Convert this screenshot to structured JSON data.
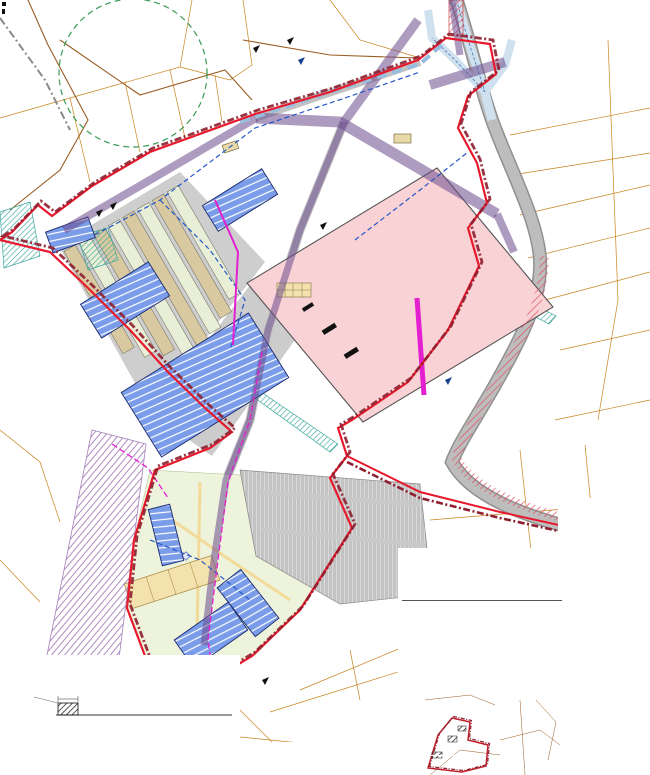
{
  "map": {
    "labels": [
      {
        "text": "Kanala tee 47",
        "sub": "35801:004:0760",
        "x": 534,
        "y": 6,
        "size": 3.2
      },
      {
        "text": "Kanala tee 41",
        "sub": "35801:004:0764",
        "x": 508,
        "y": 22,
        "size": 4.4
      },
      {
        "text": "Kanala tee 45",
        "sub": "35801:004:0771",
        "x": 497,
        "y": 57,
        "size": 3.4
      },
      {
        "text": "Kanala tee 44",
        "sub": "35801:004:0770",
        "x": 500,
        "y": 71,
        "size": 4.0
      },
      {
        "text": "Kanala tee 42",
        "sub": "35801:004:0490",
        "x": 508,
        "y": 110,
        "size": 4.2
      },
      {
        "text": "Kanala tee 42a",
        "sub": "35801:004:0480",
        "x": 505,
        "y": 134,
        "size": 3.4
      },
      {
        "text": "Kanala tee 40",
        "sub": "35801:004:0810",
        "x": 517,
        "y": 152,
        "size": 4.0
      },
      {
        "text": "Kanala tee 38",
        "sub": "35801:004:1580",
        "x": 519,
        "y": 183,
        "size": 4.0
      },
      {
        "text": "Kanala tee 36",
        "sub": "35801:004:0050",
        "x": 528,
        "y": 212,
        "size": 4.0
      },
      {
        "text": "Kanala tee 34",
        "sub": "35801:004:0040",
        "x": 560,
        "y": 252,
        "size": 4.0
      },
      {
        "text": "Kanala tee 31",
        "sub": "35801:004:1360",
        "x": 590,
        "y": 280,
        "size": 4.0
      },
      {
        "text": "Kanala tee 26",
        "sub": "35801:004:0021",
        "x": 583,
        "y": 396,
        "size": 3.8
      },
      {
        "text": "Kanala tee 24",
        "sub": "35801:004:0020",
        "x": 538,
        "y": 428,
        "size": 3.6
      },
      {
        "text": "Kanala põik 7",
        "sub": "35801:004:0100",
        "x": 546,
        "y": 464,
        "size": 3.4
      },
      {
        "text": "Laane tn 5",
        "sub": "35801:004:0110",
        "x": 477,
        "y": 490,
        "size": 3.2
      },
      {
        "text": "Pääsküla tee 22",
        "sub": "35801:004:0190",
        "x": 40,
        "y": 476,
        "size": 4.0
      },
      {
        "text": "Männiku tee 1",
        "sub": "35801:004:0310",
        "x": 168,
        "y": 737,
        "size": 3.2
      },
      {
        "text": "Kanarbiku tn",
        "sub": "35801:004:0230",
        "x": 322,
        "y": 673,
        "size": 3.2
      },
      {
        "text": "Kanala tee",
        "x": 526,
        "y": 300,
        "size": 4,
        "rot": 72,
        "color": "#888"
      },
      {
        "text": "P123",
        "x": 280,
        "y": 307,
        "size": 4,
        "bold": true,
        "box": true
      },
      {
        "text": "P65",
        "x": 247,
        "y": 540,
        "size": 3.4,
        "bold": true,
        "box": true
      },
      {
        "text": "4+1 korrust",
        "x": 163,
        "y": 540,
        "size": 2.6,
        "rot": -72,
        "color": "#ffffff"
      },
      {
        "text": "3+1 korrust",
        "x": 240,
        "y": 592,
        "size": 2.6,
        "rot": -55,
        "color": "#ffffff"
      },
      {
        "text": "4+1 korrust",
        "x": 200,
        "y": 638,
        "size": 2.6,
        "rot": -33,
        "color": "#ffffff"
      },
      {
        "text": "3+1 korrust",
        "x": 158,
        "y": 686,
        "size": 2.6,
        "rot": -25,
        "color": "#ffffff"
      },
      {
        "text": "SÕIDUTEE JA KERGLIIKLUSTEE",
        "x": 3,
        "y": 676,
        "size": 3.8,
        "bold": true,
        "color": "#1a3a6b"
      },
      {
        "text": "VAHELINE OHUTUSRIBA.",
        "x": 3,
        "y": 682,
        "size": 3.8,
        "bold": true,
        "color": "#1a3a6b"
      },
      {
        "text": "OHUTUSRIBA",
        "x": 10,
        "y": 698,
        "size": 3,
        "box": true
      },
      {
        "text": "min 2,0",
        "x": 58,
        "y": 701,
        "size": 2.8
      },
      {
        "text": "KERGLIIKLUSTEE",
        "x": 134,
        "y": 712,
        "size": 3.6,
        "bold": true
      },
      {
        "text": "LÕIGE A-A",
        "x": 3,
        "y": 690,
        "size": 2.8,
        "color": "#555"
      },
      {
        "text": "6 580 250",
        "x": 58,
        "y": 664,
        "size": 2.8,
        "rot": -90,
        "color": "#777"
      },
      {
        "text": "96-1",
        "x": 540,
        "y": 713,
        "size": 2.6,
        "color": "#8a6a3a"
      },
      {
        "text": "96-2",
        "x": 547,
        "y": 731,
        "size": 2.6,
        "color": "#8a6a3a"
      },
      {
        "text": "96-3",
        "x": 551,
        "y": 749,
        "size": 2.6,
        "color": "#8a6a3a"
      }
    ]
  },
  "legend": {
    "heading": "TINGMÄRGID",
    "items": [
      {
        "label": "PLANEERINGUALA PIIR",
        "sw": {
          "t": "dashdot",
          "c": "#8e1f2f"
        }
      },
      {
        "label": "OLEMASOLEV KRUNDIPIIR, KEHTETUKS MUUTUV PIIRIOSA (VT KA JOONIS 4)",
        "sw": {
          "t": "bracket",
          "c": "#8a8a8a"
        }
      },
      {
        "label": "PLANEERITAV KRUNDIPIIR JA KRUNDI AADRESSI ETTEPANEK",
        "sw": {
          "t": "bracket",
          "c": "#5b8fd0"
        }
      },
      {
        "label": "OLEMASOLEV HOONE",
        "sw": {
          "t": "recto",
          "c": "#ffffff",
          "c2": "#c87a4a"
        }
      },
      {
        "label": "OLEMASOLEV HOONE, LAMMUTATAV",
        "sw": {
          "t": "rect",
          "c": "#d8b78f",
          "c2": "#a06a3a"
        }
      },
      {
        "label": "PLANEERITAVA HOONE SUURIM LUBATUD EHITUSALA PIIR",
        "sw": {
          "t": "recto",
          "c": "#fde8e8",
          "c2": "#d43a3a"
        }
      },
      {
        "label": "PLANEERITAV KRUNDILE PÄÄS",
        "sw": {
          "t": "solid",
          "c": "#2456c8"
        }
      },
      {
        "label": "PLANEERITAV JUURDEPÄÄS KRUNDILE",
        "sw": {
          "t": "flag",
          "c": "#15418f"
        }
      },
      {
        "label": "OLEMASOLEV JUURDEPÄÄS",
        "sw": {
          "t": "flag",
          "c": "#111111"
        }
      },
      {
        "label": "OLEMASOLEV SÕIDUTEE",
        "sw": {
          "t": "bar",
          "c": "#2b2b2b"
        }
      },
      {
        "label": "PLANEERITAV SÕIDUTEE",
        "sw": {
          "t": "bar",
          "c": "#9c9c9c"
        }
      },
      {
        "label": "PLANEERITAV KERGLIIKLUSTEE",
        "sw": {
          "t": "bar",
          "c": "#f2da7a",
          "c2": "#8a7a30"
        }
      },
      {
        "label": "PLANEERITAV KÕNNITEE",
        "sw": {
          "t": "hatch",
          "c": "#c8a830",
          "bg": "#f7e9b0",
          "c2": "#8a7a30"
        }
      },
      {
        "label": "OLEMASOLEV KERGLIIKLUSTEE",
        "sw": {
          "t": "bar",
          "c": "#f7e9b0",
          "c2": "#8a7a30"
        }
      },
      {
        "label": "OLEMASOLEV SÄILITATAV KÕRGHALJASTUS",
        "sw": {
          "t": "trees",
          "c": "#3f8f33"
        }
      },
      {
        "label": "PLANEERITAV KÕRGHALJASTUS (PUUDERIVI)",
        "sw": {
          "t": "tree",
          "c": "#3f8f33"
        }
      },
      {
        "label": "PLANEERITAV MADALHALJASTUS (PÕÕSAD)",
        "sw": {
          "t": "tree",
          "c": "#7ab648"
        }
      },
      {
        "label": "OLEMASOLEV KRAAV",
        "sw": {
          "t": "wave",
          "c": "#2456c8"
        }
      },
      {
        "label": "PLANEERITAV KRAAV / SADEMEVEE ÄRAJUHTIMINE",
        "sw": {
          "t": "wave",
          "c": "#6fb8e8"
        }
      },
      {
        "label": "LIKVIDEERITAV KRAAVILÕIK",
        "sw": {
          "t": "dash",
          "c": "#2456c8"
        }
      },
      {
        "label": "PLANEERITAV MÜRATÕKKESEIN",
        "sw": {
          "t": "bar",
          "c": "#111111"
        }
      },
      {
        "label": "PLANEERITAV KAUBANDUS- JA TEENINDUSHOONE EHITUSALA",
        "sw": {
          "t": "rect",
          "c": "#f8d2d4",
          "c2": "#555555"
        }
      },
      {
        "label": "PLANEERITAV KORTERELAMU EHITUSALA",
        "sw": {
          "t": "rect",
          "c": "#7b9ce8",
          "c2": "#1a2a6c"
        }
      },
      {
        "label": "PLANEERITAV ÄRIHOONE EHITUSALA",
        "sw": {
          "t": "rect",
          "c": "#9cb4ee",
          "c2": "#1a2a6c"
        }
      },
      {
        "label": "PLANEERITAV MÄNGUVÄLJAK",
        "sw": {
          "t": "diamond",
          "c": "#5b6bb0"
        }
      },
      {
        "label": "PLANEERITAV PARKLA",
        "sw": {
          "t": "hatch",
          "c": "#888888",
          "bg": "#d9d9d9",
          "c2": "#888888"
        }
      },
      {
        "label": "PLANEERITAV PLATS / TEEMAA",
        "sw": {
          "t": "rect",
          "c": "#d9d9d9",
          "c2": "#888888"
        }
      },
      {
        "label": "PLANEERITAV HALJASALA",
        "sw": {
          "t": "rect",
          "c": "#cfe3b0",
          "c2": "#5f8f3f"
        }
      },
      {
        "label": "TEHNOVÕRKUDE PLANEERITAV KORIDOR",
        "sw": {
          "t": "recto",
          "c": "#ffffff",
          "c2": "#e41fd0"
        }
      },
      {
        "label": "PLANEERITAV ALAJAAM",
        "sw": {
          "t": "rect",
          "c": "#f3a8ec",
          "c2": "#b015a0"
        }
      },
      {
        "label": "PLANEERITAV ELEKTRIMAAKAABEL",
        "sw": {
          "t": "dash",
          "c": "#e41fd0"
        }
      },
      {
        "label": "PLANEERITAV GAASITORUSTIK",
        "sw": {
          "t": "hatch",
          "c": "#c8a830",
          "bg": "#f7ecc8",
          "c2": "#b09030"
        }
      },
      {
        "label": "PLANEERITAV TÄNAVAMAA LAIENDUS",
        "sw": {
          "t": "hatch",
          "c": "#d43a3a",
          "bg": "#fde8e8",
          "c2": "#d43a3a"
        }
      }
    ]
  },
  "area_info": {
    "heading": "ANDMED PLANEERINGUALA KOHTA",
    "line1_label": "Planeeritav maa-ala suurus ha",
    "line1_value": "11,2",
    "line2_label": "Krunditav maa-ala",
    "line2_value": "1",
    "col_m2": "m²",
    "col_pct": "%",
    "rows": [
      [
        "äri- ja tootmismaa Ä 70..95 / T 5..30",
        "34 515",
        "82"
      ],
      [
        "elamumaa E 100",
        "4 795",
        "7"
      ],
      [
        "transpordimaa L 100",
        "2 404",
        "4"
      ],
      [
        "üldkasutatav maa Üm 100",
        "935",
        "5"
      ],
      [
        "tootmismaa T 100",
        "585",
        "2"
      ]
    ],
    "footer_label": "Parkimiskohti kokku lubatud arv",
    "footer_value": "31"
  },
  "rights_table": {
    "note_label": "Parkimiskohtade suurim lubatud arv",
    "note_value": "31",
    "title": "KRUNTIDE EHITUSÕIGUSE NÄITAJAD",
    "columns": [
      "Krunt nr",
      "Krundi suurus m²",
      "Kasutamise sihtotstarve %",
      "Suurim ehitusalune pind m²",
      "Suurim suletud brutopind m²",
      "Täisehituse %",
      "Hoonete arv",
      "Korruselisus",
      "Parkimiskohti",
      "Kõrgus m",
      "Märkused"
    ],
    "rows": [
      [
        "1",
        "9 115",
        "T 70..95 Ä 5..30",
        "13 000",
        "10 000",
        "0",
        "2",
        "1C",
        "123",
        "-",
        "-"
      ],
      [
        "2",
        "10 726",
        "Ä 100",
        "6 720",
        "1 650",
        "8 300",
        "2,2",
        "4*",
        "140",
        "P1",
        "-"
      ],
      [
        "3",
        "1 553",
        "Ü(1)50",
        "650",
        "1 055",
        "-",
        "1",
        "1",
        "32",
        "-",
        "-"
      ],
      [
        "4",
        "4 594",
        "L 100",
        "1 767",
        "-",
        "-",
        "-",
        "-",
        "-",
        "-",
        "-"
      ],
      [
        "5",
        "660",
        "T 100",
        "100",
        "200",
        "-",
        "2",
        "-",
        "RJ",
        "-",
        "-"
      ]
    ],
    "footer": [
      "Kokku",
      "36 737",
      "",
      "15 100",
      "61 755",
      "972,6",
      "",
      "",
      "693",
      "",
      ""
    ]
  },
  "plots_table": {
    "heading": "ANDMED KRUNTIDE MOODUSTAMISEKS",
    "columns": [
      "Nr",
      "Krundi aadress",
      "Krundi planeeritud kasutamise sihtotstarve",
      "Krundi planeeritud suurus m²",
      "Moodustatakse kinnistutest (nr ja m²)",
      "Liidetakse / lahutatakse m²",
      "Osade senine sihtotstarve (%)"
    ]
  },
  "section": {
    "table": {
      "heading": "LÄHIMAD HOONED JA RAJATISED, KAUGUS (m)",
      "columns": [
        "hoone liik",
        "lubatud kaugus",
        "olemas- olev",
        "planee- ritud"
      ],
      "rows": [
        [
          "Elamud (kuni 2 korrust)",
          "5,7 (4)",
          "25",
          "9,5"
        ],
        [
          "Ühiskondlikud hooned",
          "5,7 (4)",
          "27",
          "—"
        ],
        [
          "Kauplused, bürood",
          "1,5",
          "15",
          "8"
        ],
        [
          "Abihooned",
          "1,5 (2)",
          "—",
          "—"
        ],
        [
          "Lasteasutused, koolid",
          "1,5 (3)",
          "—",
          "9"
        ]
      ],
      "footer": [
        "KOKKU",
        "",
        "",
        "124"
      ]
    },
    "note": "MÕÕDISTAMISE MÄRKUS (01.04): MÕÕDISTATUD, KEHTIB MAKSIMAALSELT 3 KUUD (V)"
  },
  "mini_legend": {
    "heading": "TINGIMÄRGID",
    "items": [
      {
        "label": "PLANEERINGUALA PIIR",
        "sw": {
          "t": "dashdot",
          "c": "#8e1f2f"
        }
      },
      {
        "label": "DETAILPLANEERINGU KONTAKTVÖÖNDI PIIR",
        "sw": {
          "t": "recto",
          "c": "#ffffff",
          "c2": "#d43a3a"
        }
      },
      {
        "label": "OLEMASOLEV HOONESTUSALA",
        "sw": {
          "t": "hatch",
          "c": "#b89a58",
          "bg": "#f0e2bc",
          "c2": "#b89a58"
        }
      },
      {
        "label": "ASUKOHASKEEM (mõõtkavata)",
        "sw": {
          "t": "recto",
          "c": "#ffffff",
          "c2": "#888888"
        }
      }
    ]
  },
  "util_legend": {
    "heading": "OLEMASOLEVAD TEHNOVÕRGUD:",
    "items": [
      {
        "label": "ELEKTRIÕHULIIN",
        "sw": {
          "t": "dashdot",
          "c": "#555555"
        }
      },
      {
        "label": "ELEKTRIMAAKAABEL",
        "sw": {
          "t": "solid",
          "c": "#555555"
        }
      },
      {
        "label": "SIDEKANALISATSIOON",
        "sw": {
          "t": "dash",
          "c": "#555555"
        }
      },
      {
        "label": "VEETORUSTIK",
        "sw": {
          "t": "solid",
          "c": "#2456c8"
        }
      },
      {
        "label": "ISEVOOLNE KANALISATSIOON",
        "sw": {
          "t": "dash",
          "c": "#7a5a2a"
        }
      },
      {
        "label": "SADEMEVEEKANALISATSIOON",
        "sw": {
          "t": "dash",
          "c": "#2a8a5a"
        }
      },
      {
        "label": "GAASITORUSTIK",
        "sw": {
          "t": "dot",
          "c": "#b09030"
        }
      }
    ]
  }
}
